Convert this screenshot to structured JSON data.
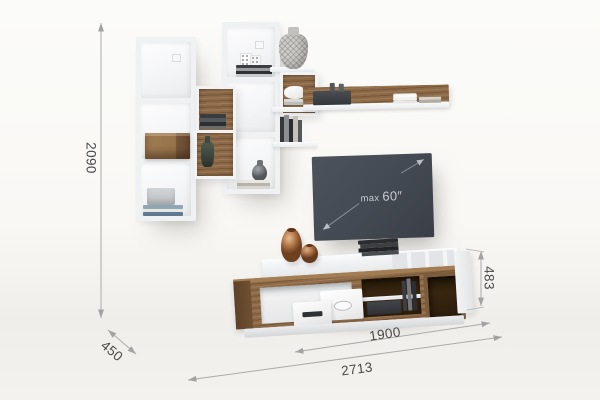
{
  "annotations": {
    "height_total": "2090",
    "depth": "450",
    "width_total": "2713",
    "stand_width": "1900",
    "stand_height": "483",
    "tv_max_prefix": "max",
    "tv_max_size": "60″"
  },
  "colors": {
    "background": "#f7f6f3",
    "furniture_white": "#f2f3f5",
    "wood": "#8a6746",
    "wood_dark": "#6a4c31",
    "tv_screen": "#454b54",
    "copper_vase": "#b27a50",
    "dimension_line": "#a8a8a8",
    "dimension_text": "#4a4a4a"
  }
}
